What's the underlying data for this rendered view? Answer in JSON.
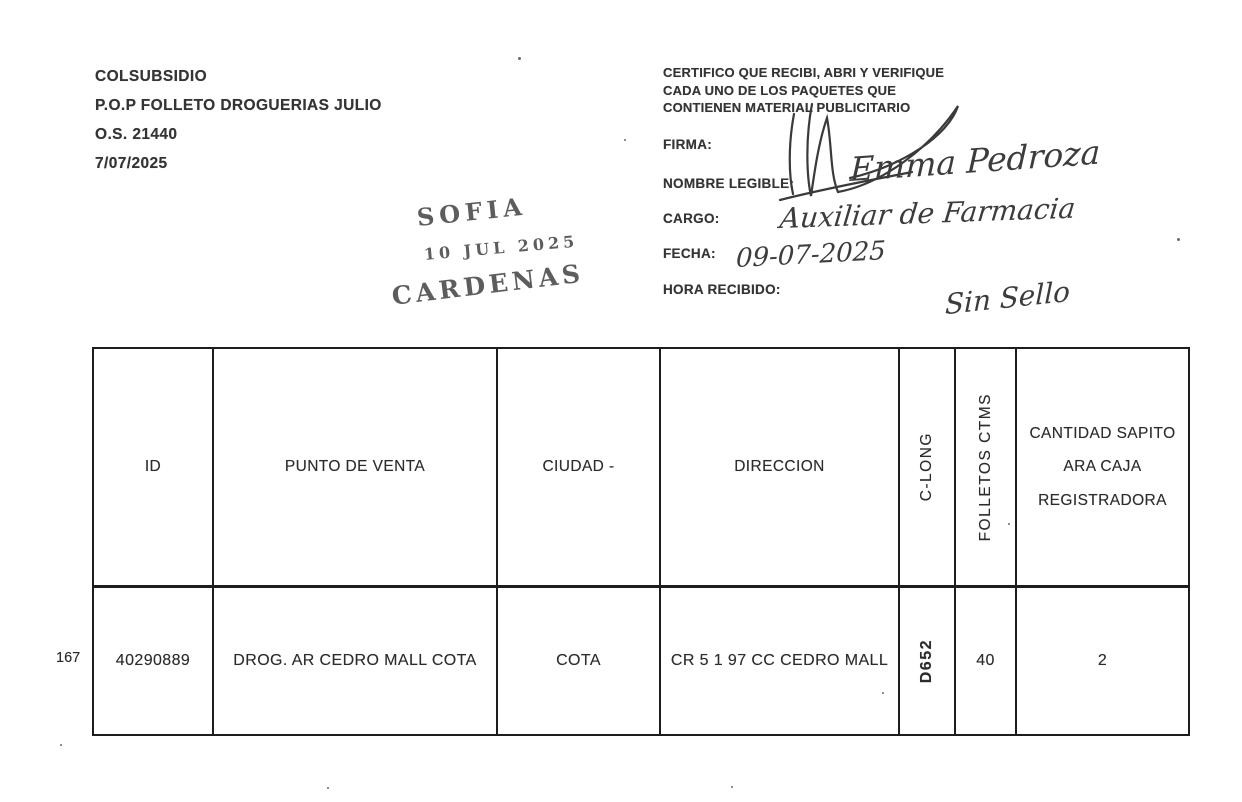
{
  "colors": {
    "ink": "#343434",
    "border": "#1d1d1d",
    "stamp": "#474747",
    "handwriting": "#3c3c3c"
  },
  "header_left": {
    "lines": [
      "COLSUBSIDIO",
      "P.O.P FOLLETO DROGUERIAS JULIO",
      "O.S. 21440",
      "7/07/2025"
    ]
  },
  "certification": {
    "lines": [
      "CERTIFICO QUE RECIBI, ABRI Y VERIFIQUE",
      "CADA  UNO DE LOS PAQUETES QUE",
      "CONTIENEN MATERIAL PUBLICITARIO"
    ]
  },
  "form": {
    "firma_label": "FIRMA:",
    "nombre_label": "NOMBRE LEGIBLE:",
    "nombre_value": "Emma Pedroza",
    "cargo_label": "CARGO:",
    "cargo_value": "Auxiliar de Farmacia",
    "fecha_label": "FECHA:",
    "fecha_value": "09-07-2025",
    "hora_label": "HORA RECIBIDO:"
  },
  "stamp": {
    "line1": "SOFIA",
    "line2": "10 JUL 2025",
    "line3": "CARDENAS"
  },
  "annotation": {
    "sin_sello": "Sin Sello"
  },
  "margin": {
    "row_number": "167"
  },
  "table": {
    "headers": [
      "ID",
      "PUNTO DE VENTA",
      "CIUDAD -",
      "DIRECCION",
      "C-LONG",
      "FOLLETOS CTMS",
      "CANTIDAD SAPITO ARA CAJA REGISTRADORA"
    ],
    "rows": [
      [
        "40290889",
        "DROG. AR CEDRO MALL COTA",
        "COTA",
        "CR 5 1 97 CC CEDRO MALL",
        "D652",
        "40",
        "2"
      ]
    ]
  }
}
